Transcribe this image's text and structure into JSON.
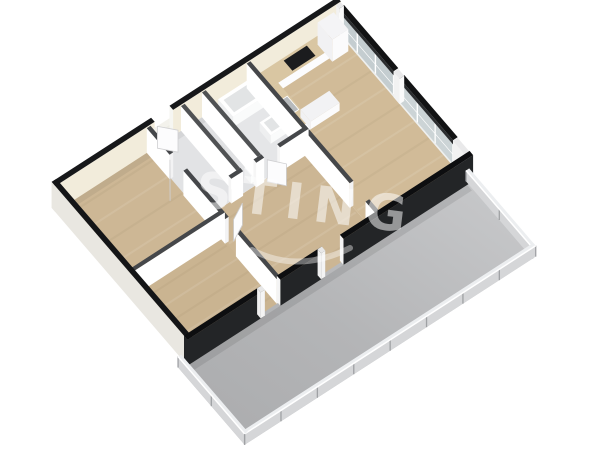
{
  "watermark": {
    "text": "STING"
  },
  "colors": {
    "background": "#ffffff",
    "wood_light": "#d1bb98",
    "wood_mid": "#cdb795",
    "wood_dark": "#cab491",
    "tile": "#e5e6e8",
    "terrace_light": "#c9cacc",
    "terrace_dark": "#aaabad",
    "exterior_wall_face": "#f2ecdb",
    "exterior_wall_top": "#17181a",
    "interior_wall_face": "#f3f3f4",
    "interior_wall_top": "#45474a",
    "se_wall_dark": "#232527",
    "glass": "#c6cfd2",
    "railing": "#d5d6d8",
    "counter_top": "#d9c6a2",
    "cooktop": "#1b1c1e",
    "watermark_white": "#ffffff"
  },
  "floorplan": {
    "rooms": [
      {
        "name": "bedroom-1"
      },
      {
        "name": "bedroom-2"
      },
      {
        "name": "entry"
      },
      {
        "name": "wc"
      },
      {
        "name": "bathroom"
      },
      {
        "name": "hall"
      },
      {
        "name": "living-room-kitchen"
      },
      {
        "name": "terrace"
      }
    ],
    "glass_wall": {
      "u0": 10.5,
      "u1": 10.68,
      "v0": 0,
      "v1": 6.5,
      "sill_h": 0.1,
      "glass_top": 0.84,
      "panes": [
        [
          0.15,
          2.9
        ],
        [
          3.2,
          5.9
        ]
      ],
      "posts": [
        [
          0,
          0.15
        ],
        [
          2.9,
          3.2
        ],
        [
          5.9,
          6.5
        ]
      ],
      "glass_colors": [
        "#c4cdd0",
        "#ccd4d6"
      ],
      "frame": "#ffffff",
      "header": "#2b2d2f",
      "header_top": "#121314",
      "sill_face": "#eef0f0",
      "sill_top": "#f6f7f7"
    },
    "scene": [
      {
        "t": "floor",
        "n": "bedroom-1-floor",
        "r": [
          -0.1,
          -0.1,
          3.4,
          3.7
        ],
        "f": "#cdb795"
      },
      {
        "t": "floor",
        "n": "bedroom-2-floor",
        "r": [
          -0.1,
          3.7,
          3.4,
          6.62
        ],
        "f": "#cab491"
      },
      {
        "t": "floor",
        "n": "hall-floor",
        "r": [
          3.35,
          2.87,
          7.2,
          6.62
        ],
        "f": "#ccb694"
      },
      {
        "t": "floor",
        "n": "living-kitchen-floor",
        "r": [
          7.2,
          -0.1,
          10.56,
          6.62
        ],
        "f": "#d1bb98"
      },
      {
        "t": "streaks",
        "n": "wood-grain",
        "r": [
          7.24,
          -0.05,
          10.5,
          6.5
        ],
        "k": 9
      },
      {
        "t": "streaks",
        "n": "wood-grain",
        "r": [
          -0.05,
          3.75,
          3.3,
          6.55
        ],
        "k": 5
      },
      {
        "t": "streaks",
        "n": "wood-grain",
        "r": [
          -0.05,
          -0.05,
          3.3,
          3.6
        ],
        "k": 5
      },
      {
        "t": "streaks",
        "n": "wood-grain",
        "r": [
          3.4,
          2.95,
          7.15,
          6.5
        ],
        "k": 5
      },
      {
        "t": "floor",
        "n": "entry-floor",
        "r": [
          3.35,
          -0.1,
          4.68,
          2.87
        ],
        "f": "#e2e3e5"
      },
      {
        "t": "floor",
        "n": "wc-floor",
        "r": [
          4.68,
          -0.1,
          5.48,
          2.87
        ],
        "f": "#e0e1e3"
      },
      {
        "t": "floor",
        "n": "bathroom-floor",
        "r": [
          5.48,
          -0.1,
          7.2,
          2.87
        ],
        "f": "#e5e6e8"
      },
      {
        "t": "flat",
        "n": "wall-shadow",
        "r": [
          -0.05,
          0,
          10.55,
          0.2
        ],
        "z": 0,
        "f": "rgba(0,0,0,0.06)"
      },
      {
        "t": "floor",
        "n": "terrace-floor",
        "r": [
          -0.45,
          6.56,
          10.56,
          9.92
        ],
        "f": "url(#terr)"
      },
      {
        "t": "flat",
        "n": "terrace-shadow",
        "r": [
          -0.25,
          6.68,
          10.45,
          6.92
        ],
        "z": 0,
        "f": "rgba(0,0,0,0.09)"
      },
      {
        "t": "wall",
        "n": "nw-wall-a",
        "r": [
          -0.18,
          -0.18,
          3.6,
          0
        ],
        "h": 1,
        "face": "#f2ecdb",
        "cap": "#e9e7e0",
        "top": "#17181a"
      },
      {
        "t": "wall",
        "n": "entrance-door-lower",
        "r": [
          3.6,
          -0.18,
          4.3,
          0
        ],
        "h": 0.52,
        "face": "#edece4",
        "cap": "#f6f6f2",
        "top": "#f3f2ec"
      },
      {
        "t": "wall",
        "n": "nw-wall-b",
        "r": [
          4.3,
          -0.18,
          10.68,
          0
        ],
        "h": 1,
        "face": "#f2ecdb",
        "cap": "#f6f6f2",
        "top": "#17181a"
      },
      {
        "t": "glass",
        "n": "ne-glass-wall"
      },
      {
        "t": "box",
        "n": "kitchen-counter",
        "r": [
          7.26,
          0.06,
          9.75,
          0.66
        ],
        "h": 0.34,
        "face": "#fcfcfd",
        "cap": "#f2f2f4",
        "top": "#d9c6a2"
      },
      {
        "t": "box",
        "n": "kitchen-tall-cabinet",
        "r": [
          9.75,
          0.06,
          10.36,
          0.8
        ],
        "h": 0.85,
        "face": "#fbfbfc",
        "cap": "#f1f1f3",
        "top": "#f4f4f6"
      },
      {
        "t": "flat",
        "n": "cooktop",
        "r": [
          8.4,
          0.14,
          9.28,
          0.58
        ],
        "z": 0.34,
        "f": "#1b1c1e"
      },
      {
        "t": "box",
        "n": "kitchen-counter-return",
        "r": [
          7.26,
          0.66,
          7.8,
          2.3
        ],
        "h": 0.34,
        "face": "#fcfcfd",
        "cap": "#f2f2f4",
        "top": "#d9c6a2"
      },
      {
        "t": "flat",
        "n": "kitchen-sink",
        "r": [
          7.32,
          1.2,
          7.74,
          1.78
        ],
        "z": 0.34,
        "f": "#b7babc",
        "s": "#ffffff"
      },
      {
        "t": "box",
        "n": "kitchen-peninsula",
        "r": [
          7.8,
          1.78,
          8.9,
          2.3
        ],
        "h": 0.3,
        "face": "#fbfbfc",
        "cap": "#f1f1f3",
        "top": "#f2f2f4"
      },
      {
        "t": "box",
        "n": "bathtub",
        "r": [
          5.95,
          0.08,
          7.1,
          0.84
        ],
        "h": 0.4,
        "face": "#fafbfb",
        "cap": "#eeeff0",
        "top": "#ffffff"
      },
      {
        "t": "flat",
        "n": "bathtub-basin",
        "r": [
          6.07,
          0.2,
          6.99,
          0.73
        ],
        "z": 0.4,
        "f": "#e2e4e5"
      },
      {
        "t": "box",
        "n": "bathroom-sink",
        "r": [
          6.52,
          1.42,
          7.1,
          1.98
        ],
        "h": 0.32,
        "face": "#fafbfb",
        "cap": "#eeeff0",
        "top": "#ffffff"
      },
      {
        "t": "flat",
        "n": "bathroom-sink-bowl",
        "r": [
          6.62,
          1.5,
          7.02,
          1.9
        ],
        "z": 0.32,
        "f": "#e2e4e5"
      },
      {
        "t": "box",
        "n": "toilet-tank",
        "r": [
          4.66,
          1.02,
          4.82,
          1.58
        ],
        "h": 0.34,
        "face": "#fafbfb",
        "cap": "#eeeff0",
        "top": "#f6f7f8"
      },
      {
        "t": "ell",
        "n": "toilet-bowl",
        "c": [
          4.98,
          1.3
        ],
        "rx": 8,
        "ry": 5.5,
        "z": 0.16,
        "f": "#fcfdfd",
        "s": "#d9dadb"
      },
      {
        "t": "box",
        "n": "wc-basin",
        "r": [
          5.2,
          2.4,
          5.4,
          2.74
        ],
        "h": 0.3,
        "face": "#fafbfb",
        "cap": "#eeeff0",
        "top": "#f6f7f8"
      },
      {
        "t": "wall",
        "n": "living-wall-a",
        "r": [
          7.1,
          0,
          7.24,
          5.2
        ],
        "h": 0.95,
        "face": "#f3f3f4",
        "cap": "#ffffff",
        "top": "#45474a"
      },
      {
        "t": "wall",
        "n": "living-wall-b",
        "r": [
          7.1,
          6.0,
          7.24,
          6.56
        ],
        "h": 0.95,
        "face": "#f3f3f4",
        "cap": "#ffffff",
        "top": "#45474a"
      },
      {
        "t": "wall",
        "n": "bath-wc-wall",
        "r": [
          5.4,
          0,
          5.54,
          2.8
        ],
        "h": 0.95,
        "face": "#f3f3f4",
        "cap": "#ffffff",
        "top": "#505254"
      },
      {
        "t": "wall",
        "n": "wc-entry-wall",
        "r": [
          4.6,
          0,
          4.74,
          2.8
        ],
        "h": 0.95,
        "face": "#f3f3f4",
        "cap": "#ffffff",
        "top": "#505254"
      },
      {
        "t": "wall",
        "n": "bath-south-wall-a",
        "r": [
          4.3,
          2.8,
          4.75,
          2.94
        ],
        "h": 0.95,
        "face": "#ffffff",
        "cap": "#f6f6f6",
        "top": "#45474a"
      },
      {
        "t": "wall",
        "n": "bath-south-wall-b",
        "r": [
          5.25,
          2.8,
          5.55,
          2.94
        ],
        "h": 0.95,
        "face": "#ffffff",
        "cap": "#f6f6f6",
        "top": "#45474a"
      },
      {
        "t": "wall",
        "n": "bath-south-wall-c",
        "r": [
          6.15,
          2.8,
          7.24,
          2.94
        ],
        "h": 0.95,
        "face": "#ffffff",
        "cap": "#f6f6f6",
        "top": "#45474a"
      },
      {
        "t": "wall",
        "n": "bedrooms-wall-a",
        "r": [
          3.3,
          0,
          3.44,
          1.15
        ],
        "h": 0.95,
        "face": "#f3f3f4",
        "cap": "#ffffff",
        "top": "#45474a"
      },
      {
        "t": "wall",
        "n": "bedrooms-wall-b",
        "r": [
          3.3,
          1.85,
          3.44,
          3.95
        ],
        "h": 0.95,
        "face": "#f3f3f4",
        "cap": "#ffffff",
        "top": "#45474a"
      },
      {
        "t": "wall",
        "n": "bedrooms-wall-c",
        "r": [
          3.3,
          4.5,
          3.44,
          6.56
        ],
        "h": 0.95,
        "face": "#f3f3f4",
        "cap": "#ffffff",
        "top": "#45474a"
      },
      {
        "t": "wall",
        "n": "bedroom-divider-wall",
        "r": [
          0,
          3.62,
          3.44,
          3.76
        ],
        "h": 0.95,
        "face": "#ffffff",
        "cap": "#f6f6f6",
        "top": "#45474a"
      },
      {
        "t": "wall",
        "n": "sw-wall",
        "r": [
          -0.18,
          -0.18,
          0,
          6.68
        ],
        "h": 1,
        "face": "#e9e7e1",
        "cap": "#e9e7e1",
        "top": "#141517"
      },
      {
        "t": "leaf",
        "n": "entry-door-leaf",
        "a": [
          3.66,
          0.06
        ],
        "b": [
          4.08,
          0.54
        ]
      },
      {
        "t": "leaf",
        "n": "bedroom-1-door-leaf",
        "a": [
          3.26,
          1.22
        ],
        "b": [
          2.86,
          1.76
        ]
      },
      {
        "t": "leaf",
        "n": "bedroom-2-door-leaf",
        "a": [
          3.56,
          4.04
        ],
        "b": [
          4.12,
          3.74
        ]
      },
      {
        "t": "leaf",
        "n": "bathroom-door-leaf",
        "a": [
          5.64,
          2.98
        ],
        "b": [
          6.02,
          3.44
        ]
      },
      {
        "t": "wall",
        "n": "se-wall-a",
        "r": [
          -0.18,
          6.5,
          2.75,
          6.68
        ],
        "h": 1,
        "face": "#232527",
        "cap": "#232527",
        "top": "#0d0e10"
      },
      {
        "t": "wall",
        "n": "se-door-jamb-a",
        "r": [
          2.6,
          6.5,
          2.76,
          6.68
        ],
        "h": 1,
        "face": "#f4f4f4",
        "cap": "#f0f0f0",
        "top": "#e8e8e8"
      },
      {
        "t": "wall",
        "n": "se-wall-b",
        "r": [
          3.35,
          6.5,
          5.05,
          6.68
        ],
        "h": 1,
        "face": "#232527",
        "cap": "#f4f4f4",
        "top": "#0d0e10"
      },
      {
        "t": "wall",
        "n": "se-door-jamb-b",
        "r": [
          4.9,
          6.5,
          5.06,
          6.68
        ],
        "h": 1,
        "face": "#f4f4f4",
        "cap": "#f0f0f0",
        "top": "#e8e8e8"
      },
      {
        "t": "wall",
        "n": "se-wall-c",
        "r": [
          5.75,
          6.5,
          10.68,
          6.68
        ],
        "h": 1,
        "face": "#232527",
        "cap": "#f4f4f4",
        "top": "#0d0e10"
      },
      {
        "t": "rail",
        "n": "terrace-railing-ne",
        "r": [
          10.5,
          6.56,
          10.62,
          9.92
        ],
        "h": 0.42,
        "o": "v"
      },
      {
        "t": "rail",
        "n": "terrace-railing-se",
        "r": [
          -0.45,
          9.8,
          10.62,
          9.92
        ],
        "h": 0.42,
        "o": "u"
      },
      {
        "t": "rail",
        "n": "terrace-railing-sw",
        "r": [
          -0.45,
          6.56,
          -0.33,
          9.92
        ],
        "h": 0.42,
        "o": "v"
      }
    ]
  }
}
